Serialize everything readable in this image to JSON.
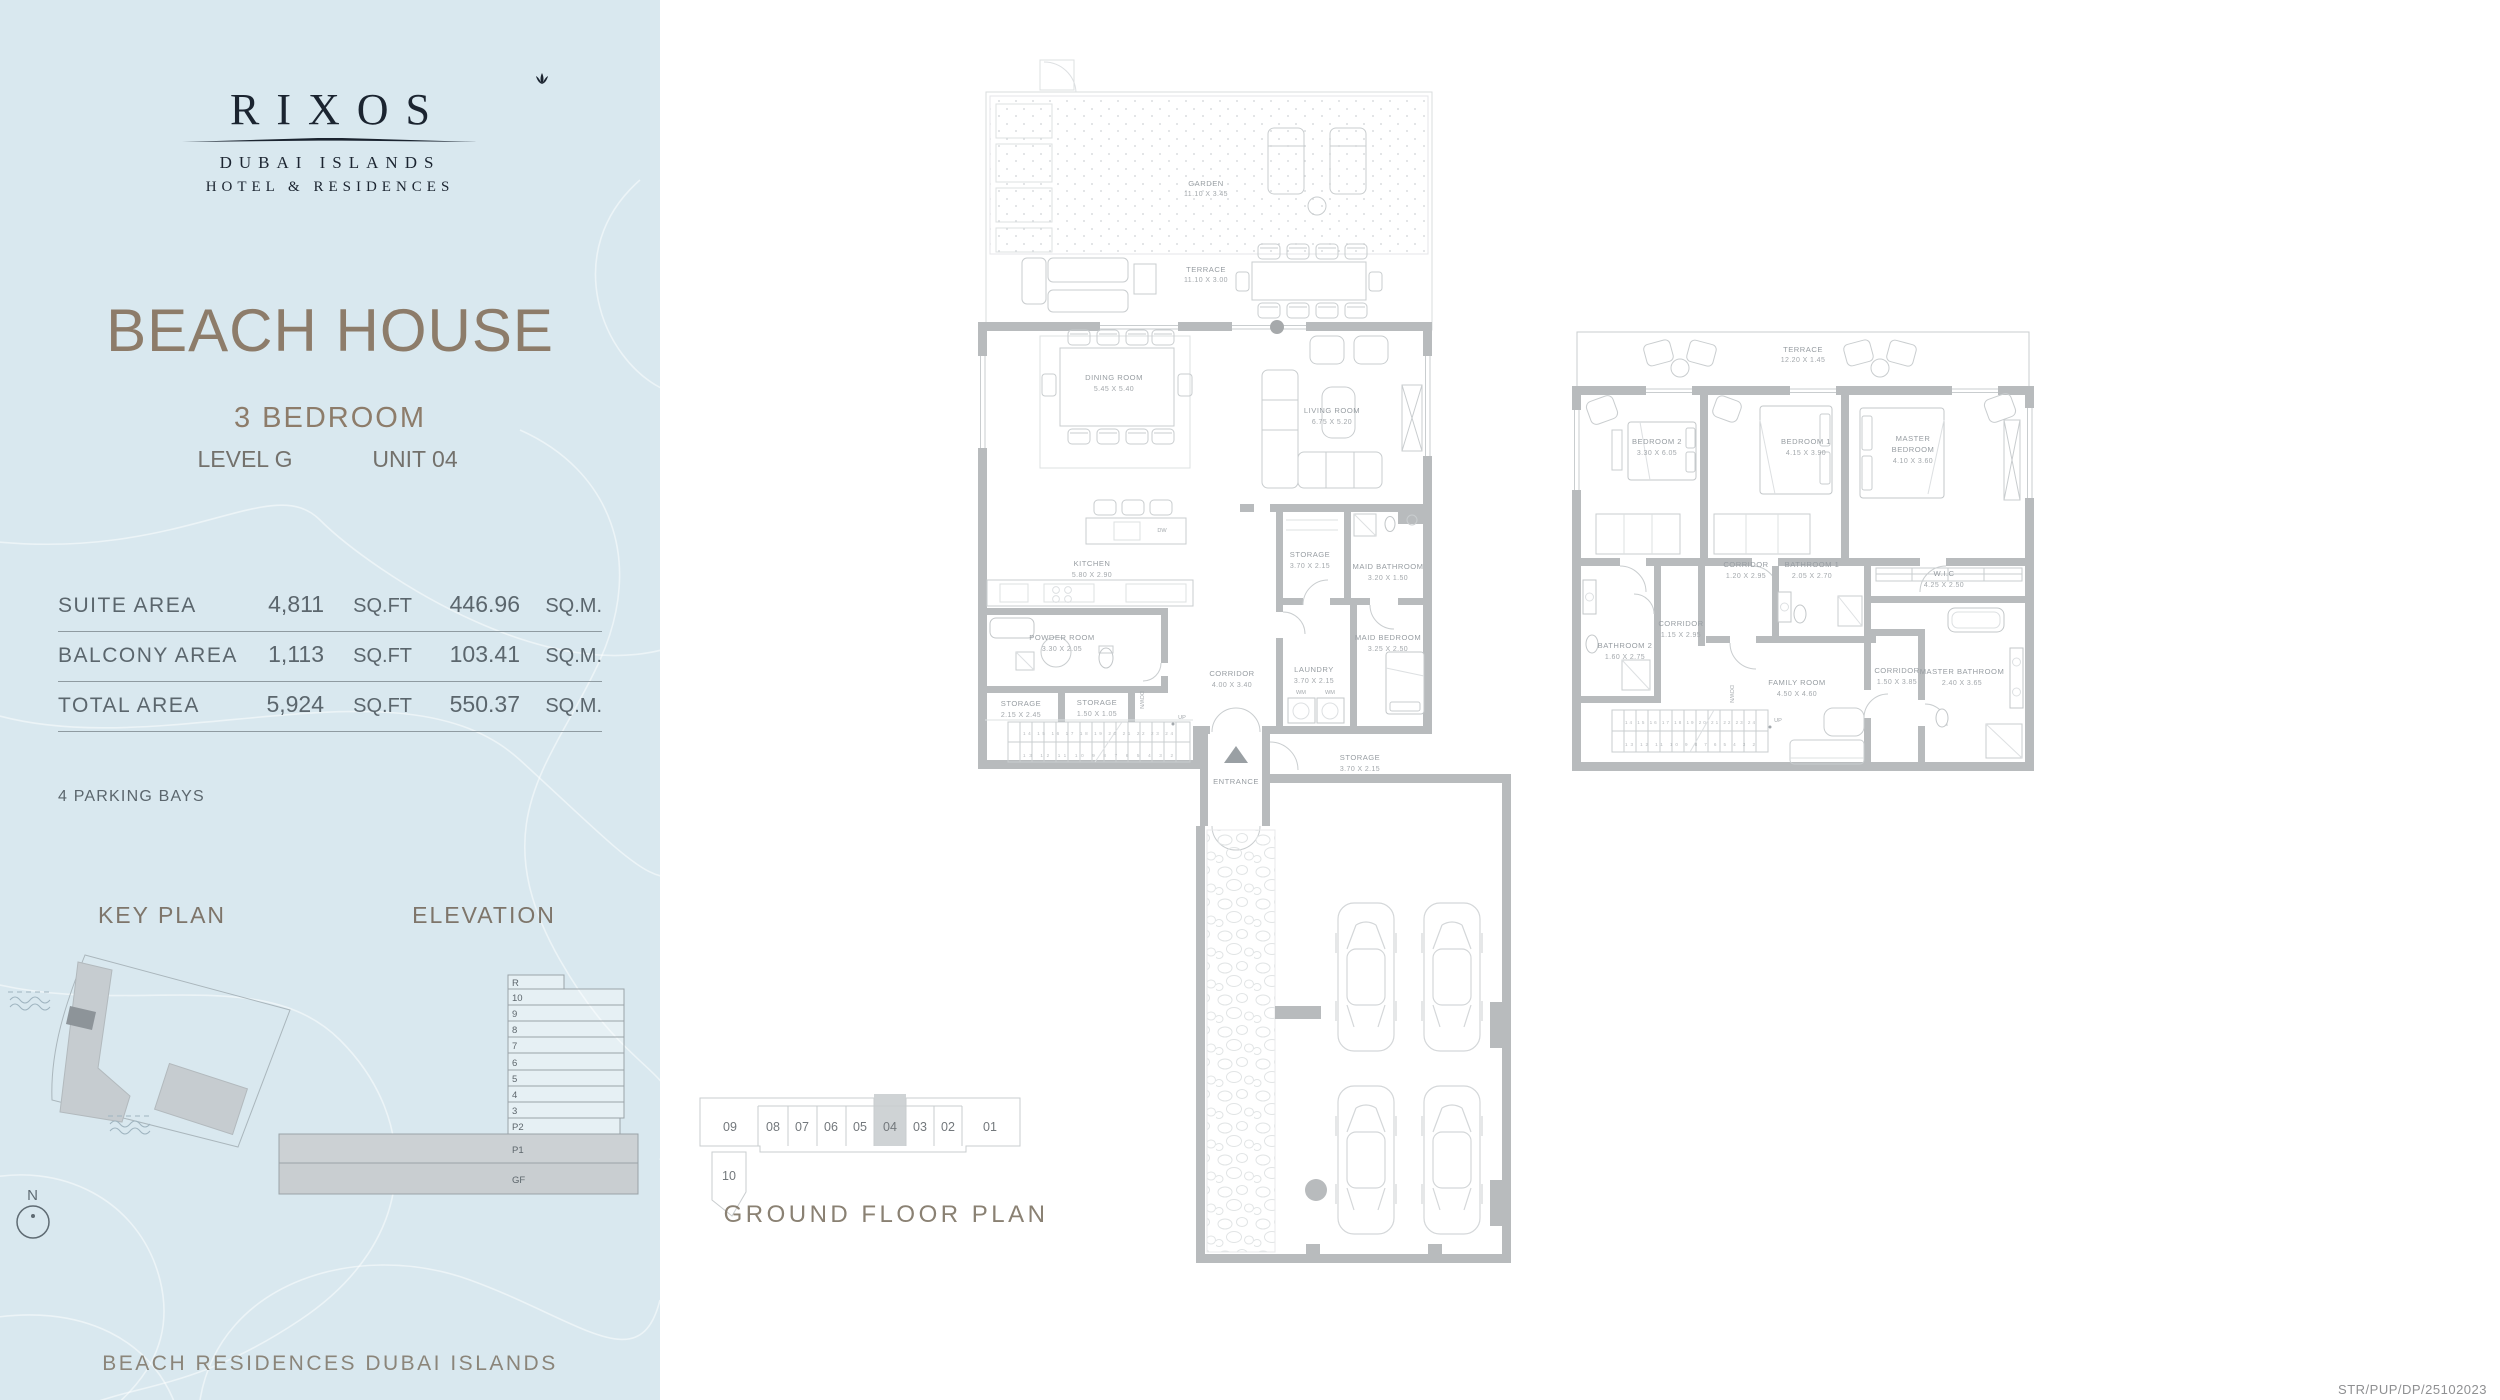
{
  "sidebar": {
    "logo": {
      "brand": "RIXOS",
      "sub1": "DUBAI ISLANDS",
      "sub2": "HOTEL & RESIDENCES"
    },
    "title": "BEACH HOUSE",
    "subtitle": "3 BEDROOM",
    "level": "LEVEL G",
    "unit": "UNIT 04",
    "areas": [
      {
        "label": "SUITE AREA",
        "sqft": "4,811",
        "sqft_unit": "SQ.FT",
        "sqm": "446.96",
        "sqm_unit": "SQ.M."
      },
      {
        "label": "BALCONY AREA",
        "sqft": "1,113",
        "sqft_unit": "SQ.FT",
        "sqm": "103.41",
        "sqm_unit": "SQ.M."
      },
      {
        "label": "TOTAL AREA",
        "sqft": "5,924",
        "sqft_unit": "SQ.FT",
        "sqm": "550.37",
        "sqm_unit": "SQ.M."
      }
    ],
    "parking_note": "4 PARKING BAYS",
    "key_plan_title": "KEY PLAN",
    "elevation_title": "ELEVATION",
    "elevation_floors": [
      "R",
      "10",
      "9",
      "8",
      "7",
      "6",
      "5",
      "4",
      "3",
      "P2",
      "P1",
      "GF"
    ],
    "compass": "N",
    "footer": "BEACH RESIDENCES DUBAI ISLANDS",
    "colors": {
      "panel_bg": "#d9e8ef",
      "accent_taupe": "#8d7c6a",
      "logo_ink": "#1b2430"
    }
  },
  "plans": {
    "colors": {
      "wall_gray": "#b8bbbd",
      "highlight_cell": "#cfd3d5",
      "label_gray": "#979da2"
    },
    "left_plan": {
      "garden": {
        "name": "GARDEN",
        "dims": "11.10 X 3.45"
      },
      "terrace": {
        "name": "TERRACE",
        "dims": "11.10 X 3.00"
      },
      "dining_room": {
        "name": "DINING ROOM",
        "dims": "5.45 X 5.40"
      },
      "living_room": {
        "name": "LIVING ROOM",
        "dims": "6.75 X 5.20"
      },
      "kitchen": {
        "name": "KITCHEN",
        "dims": "5.80 X 2.90"
      },
      "powder_room": {
        "name": "POWDER ROOM",
        "dims": "3.30 X 2.05"
      },
      "storage_a": {
        "name": "STORAGE",
        "dims": "2.15 X 2.45"
      },
      "storage_b": {
        "name": "STORAGE",
        "dims": "1.50 X 1.05"
      },
      "corridor": {
        "name": "CORRIDOR",
        "dims": "4.00 X 3.40"
      },
      "storage_c": {
        "name": "STORAGE",
        "dims": "3.70 X 2.15"
      },
      "maid_bathroom": {
        "name": "MAID BATHROOM",
        "dims": "3.20 X 1.50"
      },
      "laundry": {
        "name": "LAUNDRY",
        "dims": "3.70 X 2.15"
      },
      "maid_bedroom": {
        "name": "MAID BEDROOM",
        "dims": "3.25 X 2.50"
      },
      "entrance": {
        "name": "ENTRANCE"
      },
      "storage_d": {
        "name": "STORAGE",
        "dims": "3.70 X 2.15"
      },
      "up": "UP",
      "down": "DOWN",
      "dw": "DW",
      "wm": "WM",
      "stairs_top": "14 15 16 17 18 19 20 21 22 23 24",
      "stairs_bottom": "13 12 11 10 9 8 7 6 5 4 3 2"
    },
    "right_plan": {
      "terrace": {
        "name": "TERRACE",
        "dims": "12.20 X 1.45"
      },
      "bedroom2": {
        "name": "BEDROOM 2",
        "dims": "3.30 X 6.05"
      },
      "bedroom1": {
        "name": "BEDROOM 1",
        "dims": "4.15 X 3.90"
      },
      "master_bedroom": {
        "line1": "MASTER",
        "line2": "BEDROOM",
        "dims": "4.10 X 3.60"
      },
      "corridor_a": {
        "name": "CORRIDOR",
        "dims": "1.20 X 2.95"
      },
      "bathroom1": {
        "name": "BATHROOM 1",
        "dims": "2.05 X 2.70"
      },
      "wic": {
        "name": "W.I.C",
        "dims": "4.25 X 2.50"
      },
      "bathroom2": {
        "name": "BATHROOM 2",
        "dims": "1.60 X 2.75"
      },
      "corridor_b": {
        "name": "CORRIDOR",
        "dims": "1.15 X 2.95"
      },
      "family_room": {
        "name": "FAMILY ROOM",
        "dims": "4.50 X 4.60"
      },
      "corridor_c": {
        "name": "CORRIDOR",
        "dims": "1.50 X 3.85"
      },
      "master_bathroom": {
        "name": "MASTER BATHROOM",
        "dims": "2.40 X 3.65"
      },
      "up": "UP",
      "down": "DOWN",
      "stairs_top": "14 15 16 17 18 19 20 21 22 23 24",
      "stairs_bottom": "13 12 11 10 9 8 7 6 5 4 3 2"
    },
    "strip": {
      "units": [
        "09",
        "08",
        "07",
        "06",
        "05",
        "04",
        "03",
        "02",
        "01"
      ],
      "unit_below": "10",
      "highlighted_unit": "04",
      "caption": "GROUND FLOOR PLAN"
    },
    "ref_code": "STR/PUP/DP/25102023"
  }
}
